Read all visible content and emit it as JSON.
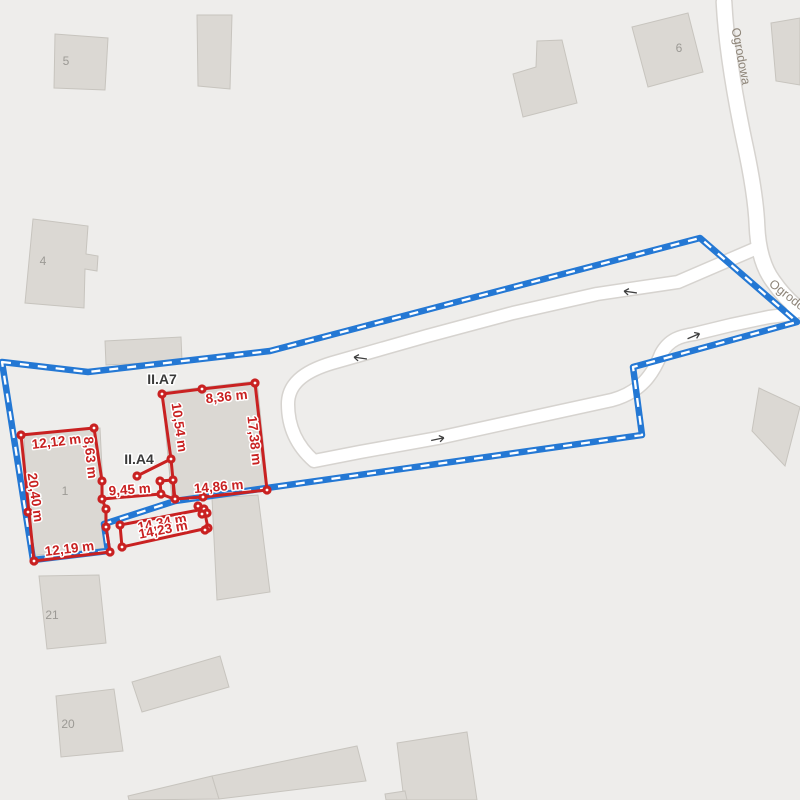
{
  "map": {
    "background": "#eeedeb",
    "street_name": "Ogrodowa",
    "colors": {
      "building_fill": "#dbd8d3",
      "building_stroke": "#c7c4be",
      "building_label": "#9c9a95",
      "road_fill": "#ffffff",
      "road_casing": "#d6d3cf",
      "boundary_blue": "#2478d4",
      "boundary_dash_white": "#ffffff",
      "sketch_red": "#c92121",
      "area_label_dark": "#3a3a3a",
      "street_label": "#8d8478",
      "arrow": "#3f3f3f"
    },
    "street_labels": [
      {
        "text": "Ogrodowa",
        "x": 737,
        "y": 57,
        "rot": 79,
        "size": 12.5
      },
      {
        "text": "Ogrodowa",
        "x": 791,
        "y": 303,
        "rot": 38,
        "size": 12.5
      }
    ],
    "buildings": [
      {
        "label": "5",
        "label_x": 66,
        "label_y": 61,
        "points": [
          [
            55,
            34
          ],
          [
            108,
            38
          ],
          [
            105,
            90
          ],
          [
            54,
            88
          ]
        ]
      },
      {
        "label": "",
        "points": [
          [
            197,
            15
          ],
          [
            232,
            15
          ],
          [
            230,
            89
          ],
          [
            198,
            86
          ]
        ]
      },
      {
        "label": "6",
        "label_x": 679,
        "label_y": 48,
        "points": [
          [
            632,
            27
          ],
          [
            688,
            13
          ],
          [
            703,
            72
          ],
          [
            648,
            87
          ]
        ]
      },
      {
        "label": "",
        "points": [
          [
            537,
            41
          ],
          [
            562,
            40
          ],
          [
            577,
            103
          ],
          [
            523,
            117
          ],
          [
            513,
            74
          ],
          [
            536,
            67
          ]
        ]
      },
      {
        "label": "",
        "points": [
          [
            771,
            23
          ],
          [
            800,
            18
          ],
          [
            800,
            85
          ],
          [
            776,
            81
          ]
        ]
      },
      {
        "label": "4",
        "label_x": 43,
        "label_y": 261,
        "points": [
          [
            33,
            219
          ],
          [
            88,
            226
          ],
          [
            86,
            254
          ],
          [
            98,
            256
          ],
          [
            97,
            271
          ],
          [
            85,
            269
          ],
          [
            84,
            308
          ],
          [
            25,
            303
          ]
        ]
      },
      {
        "label": "",
        "points": [
          [
            105,
            341
          ],
          [
            181,
            337
          ],
          [
            182,
            361
          ],
          [
            106,
            365
          ]
        ]
      },
      {
        "label": "1",
        "label_x": 65,
        "label_y": 491,
        "points": [
          [
            24,
            436
          ],
          [
            100,
            428
          ],
          [
            106,
            548
          ],
          [
            30,
            556
          ]
        ]
      },
      {
        "label": "",
        "points": [
          [
            162,
            392
          ],
          [
            257,
            381
          ],
          [
            268,
            490
          ],
          [
            172,
            500
          ]
        ]
      },
      {
        "label": "",
        "points": [
          [
            212,
            498
          ],
          [
            258,
            495
          ],
          [
            270,
            592
          ],
          [
            217,
            600
          ]
        ]
      },
      {
        "label": "21",
        "label_x": 52,
        "label_y": 615,
        "points": [
          [
            39,
            576
          ],
          [
            99,
            575
          ],
          [
            106,
            643
          ],
          [
            47,
            649
          ]
        ]
      },
      {
        "label": "20",
        "label_x": 68,
        "label_y": 724,
        "points": [
          [
            56,
            696
          ],
          [
            114,
            689
          ],
          [
            123,
            751
          ],
          [
            61,
            757
          ]
        ]
      },
      {
        "label": "",
        "points": [
          [
            132,
            682
          ],
          [
            220,
            656
          ],
          [
            229,
            687
          ],
          [
            142,
            712
          ]
        ]
      },
      {
        "label": "",
        "points": [
          [
            128,
            796
          ],
          [
            212,
            776
          ],
          [
            219,
            799
          ],
          [
            129,
            800
          ]
        ]
      },
      {
        "label": "",
        "points": [
          [
            212,
            776
          ],
          [
            357,
            746
          ],
          [
            366,
            781
          ],
          [
            219,
            799
          ]
        ]
      },
      {
        "label": "",
        "points": [
          [
            397,
            743
          ],
          [
            467,
            732
          ],
          [
            477,
            800
          ],
          [
            404,
            800
          ]
        ]
      },
      {
        "label": "",
        "points": [
          [
            385,
            794
          ],
          [
            405,
            791
          ],
          [
            407,
            800
          ],
          [
            386,
            800
          ]
        ]
      },
      {
        "label": "",
        "points": [
          [
            759,
            388
          ],
          [
            800,
            407
          ],
          [
            785,
            466
          ],
          [
            752,
            431
          ]
        ]
      }
    ],
    "roads": [
      {
        "name": "road-loop",
        "width": 12,
        "casing": 15,
        "path": "M757,248 L678,282 L597,294 L513,313 L427,336 L332,363 C302,372 288,385 288,404 C288,428 298,447 314,461 L360,452 L438,438 L557,412 L612,400 C641,392 653,374 661,354 C669,339 681,336 694,334 L731,325 L769,317 L793,314"
      },
      {
        "name": "road-ogrodowa",
        "width": 14.5,
        "casing": 17.5,
        "path": "M724,2 C726,42 734,92 744,140 C751,172 756,200 757,226 C758,250 764,269 773,281 C782,294 791,303 800,310"
      }
    ],
    "arrows": [
      {
        "x": 360,
        "y": 358,
        "rot": 188
      },
      {
        "x": 630,
        "y": 292,
        "rot": 188
      },
      {
        "x": 438,
        "y": 439,
        "rot": -12
      },
      {
        "x": 694,
        "y": 336,
        "rot": -23
      }
    ],
    "boundary": {
      "closed": true,
      "points": [
        [
          2,
          362
        ],
        [
          88,
          372
        ],
        [
          270,
          351
        ],
        [
          700,
          238
        ],
        [
          797,
          322
        ],
        [
          633,
          367
        ],
        [
          642,
          435
        ],
        [
          175,
          501
        ],
        [
          104,
          524
        ],
        [
          108,
          551
        ],
        [
          33,
          560
        ]
      ]
    },
    "sketch": {
      "lines": [
        {
          "closed": true,
          "points": [
            [
              21,
              435
            ],
            [
              94,
              428
            ],
            [
              102,
              481
            ],
            [
              102,
              499
            ],
            [
              106,
              509
            ],
            [
              106,
              527
            ],
            [
              110,
              552
            ],
            [
              34,
              561
            ]
          ]
        },
        {
          "closed": true,
          "points": [
            [
              162,
              394
            ],
            [
              202,
              389
            ],
            [
              255,
              383
            ],
            [
              267,
              490
            ],
            [
              203,
              497
            ],
            [
              175,
              499
            ],
            [
              173,
              480
            ],
            [
              171,
              459
            ]
          ]
        },
        {
          "closed": true,
          "points": [
            [
              160,
              481
            ],
            [
              173,
              480
            ],
            [
              174,
              499
            ],
            [
              161,
              494
            ]
          ]
        },
        {
          "closed": false,
          "points": [
            [
              102,
              499
            ],
            [
              161,
              494
            ]
          ]
        },
        {
          "closed": false,
          "points": [
            [
              171,
              459
            ],
            [
              137,
              476
            ]
          ]
        },
        {
          "closed": true,
          "points": [
            [
              120,
              525
            ],
            [
              204,
              509
            ],
            [
              208,
              528
            ],
            [
              122,
              547
            ]
          ]
        }
      ],
      "dots": [
        [
          21,
          435
        ],
        [
          94,
          428
        ],
        [
          102,
          481
        ],
        [
          102,
          499
        ],
        [
          106,
          509
        ],
        [
          106,
          527
        ],
        [
          110,
          552
        ],
        [
          34,
          561
        ],
        [
          28,
          512
        ],
        [
          162,
          394
        ],
        [
          202,
          389
        ],
        [
          255,
          383
        ],
        [
          267,
          490
        ],
        [
          203,
          497
        ],
        [
          175,
          499
        ],
        [
          173,
          480
        ],
        [
          171,
          459
        ],
        [
          160,
          481
        ],
        [
          161,
          494
        ],
        [
          137,
          476
        ],
        [
          120,
          525
        ],
        [
          204,
          509
        ],
        [
          208,
          528
        ],
        [
          122,
          547
        ],
        [
          198,
          506
        ],
        [
          207,
          513
        ],
        [
          202,
          514
        ],
        [
          205,
          530
        ]
      ],
      "measurement_labels": [
        {
          "text": "12,12 m",
          "x": 57,
          "y": 442,
          "rot": -7
        },
        {
          "text": "8,63 m",
          "x": 86,
          "y": 454,
          "rot": 84
        },
        {
          "text": "20,40 m",
          "x": 31,
          "y": 494,
          "rot": 82
        },
        {
          "text": "12,19 m",
          "x": 70,
          "y": 549,
          "rot": -7
        },
        {
          "text": "9,45 m",
          "x": 130,
          "y": 490,
          "rot": -4
        },
        {
          "text": "10,54 m",
          "x": 175,
          "y": 424,
          "rot": 82
        },
        {
          "text": "8,36 m",
          "x": 227,
          "y": 397,
          "rot": -6
        },
        {
          "text": "17,38 m",
          "x": 250,
          "y": 437,
          "rot": 84
        },
        {
          "text": "14,86 m",
          "x": 219,
          "y": 487,
          "rot": -5
        },
        {
          "text": "14,34 m",
          "x": 163,
          "y": 523,
          "rot": -11
        },
        {
          "text": "14,23 m",
          "x": 164,
          "y": 530,
          "rot": -11
        }
      ],
      "area_labels": [
        {
          "text": "II.A7",
          "x": 162,
          "y": 380
        },
        {
          "text": "II.A4",
          "x": 139,
          "y": 460
        }
      ]
    }
  }
}
